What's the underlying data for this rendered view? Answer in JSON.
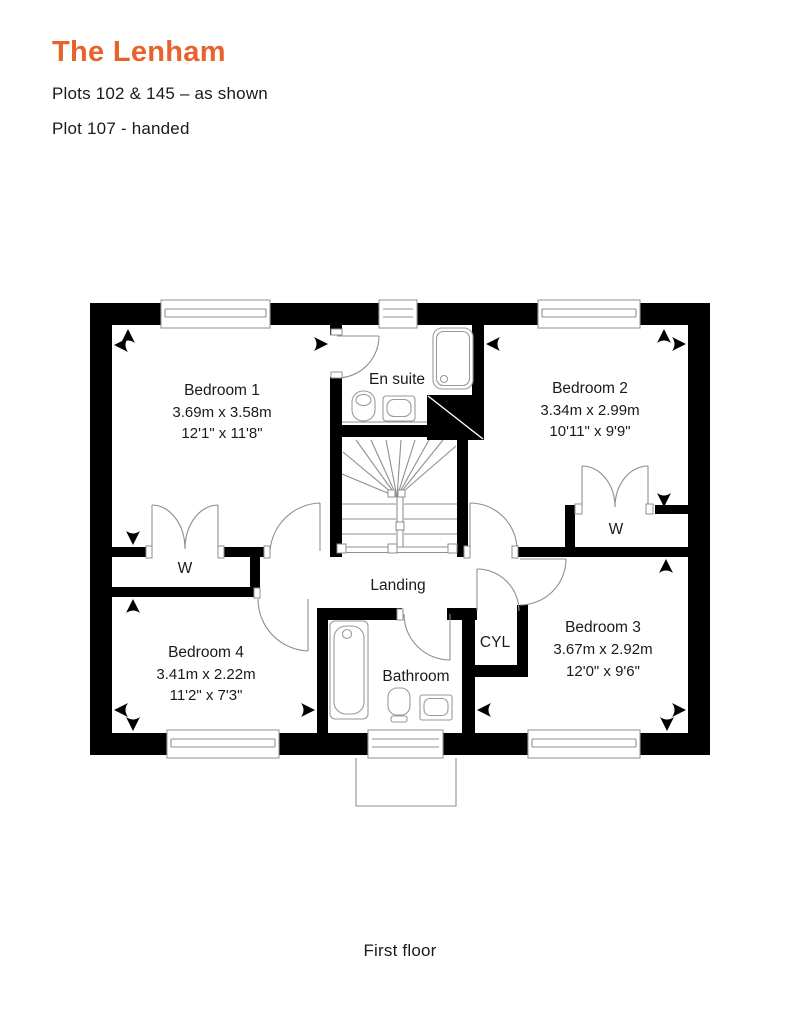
{
  "header": {
    "title": "The Lenham",
    "plots_line1": "Plots 102 & 145 – as shown",
    "plots_line2": "Plot 107 - handed"
  },
  "floorplan": {
    "caption": "First floor",
    "rooms": {
      "bedroom1": {
        "name": "Bedroom 1",
        "metric": "3.69m x 3.58m",
        "imperial": "12'1\" x 11'8\""
      },
      "bedroom2": {
        "name": "Bedroom 2",
        "metric": "3.34m x 2.99m",
        "imperial": "10'11\" x 9'9\""
      },
      "bedroom3": {
        "name": "Bedroom 3",
        "metric": "3.67m x 2.92m",
        "imperial": "12'0\" x 9'6\""
      },
      "bedroom4": {
        "name": "Bedroom 4",
        "metric": "3.41m x 2.22m",
        "imperial": "11'2\" x 7'3\""
      },
      "ensuite": {
        "name": "En suite"
      },
      "bathroom": {
        "name": "Bathroom"
      },
      "landing": {
        "name": "Landing"
      },
      "cylinder": {
        "name": "CYL"
      },
      "wardrobe1": {
        "name": "W"
      },
      "wardrobe2": {
        "name": "W"
      }
    }
  },
  "colors": {
    "accent": "#E8622D",
    "wall": "#000000",
    "line": "#8F8F8F",
    "text": "#1A1A1A"
  }
}
